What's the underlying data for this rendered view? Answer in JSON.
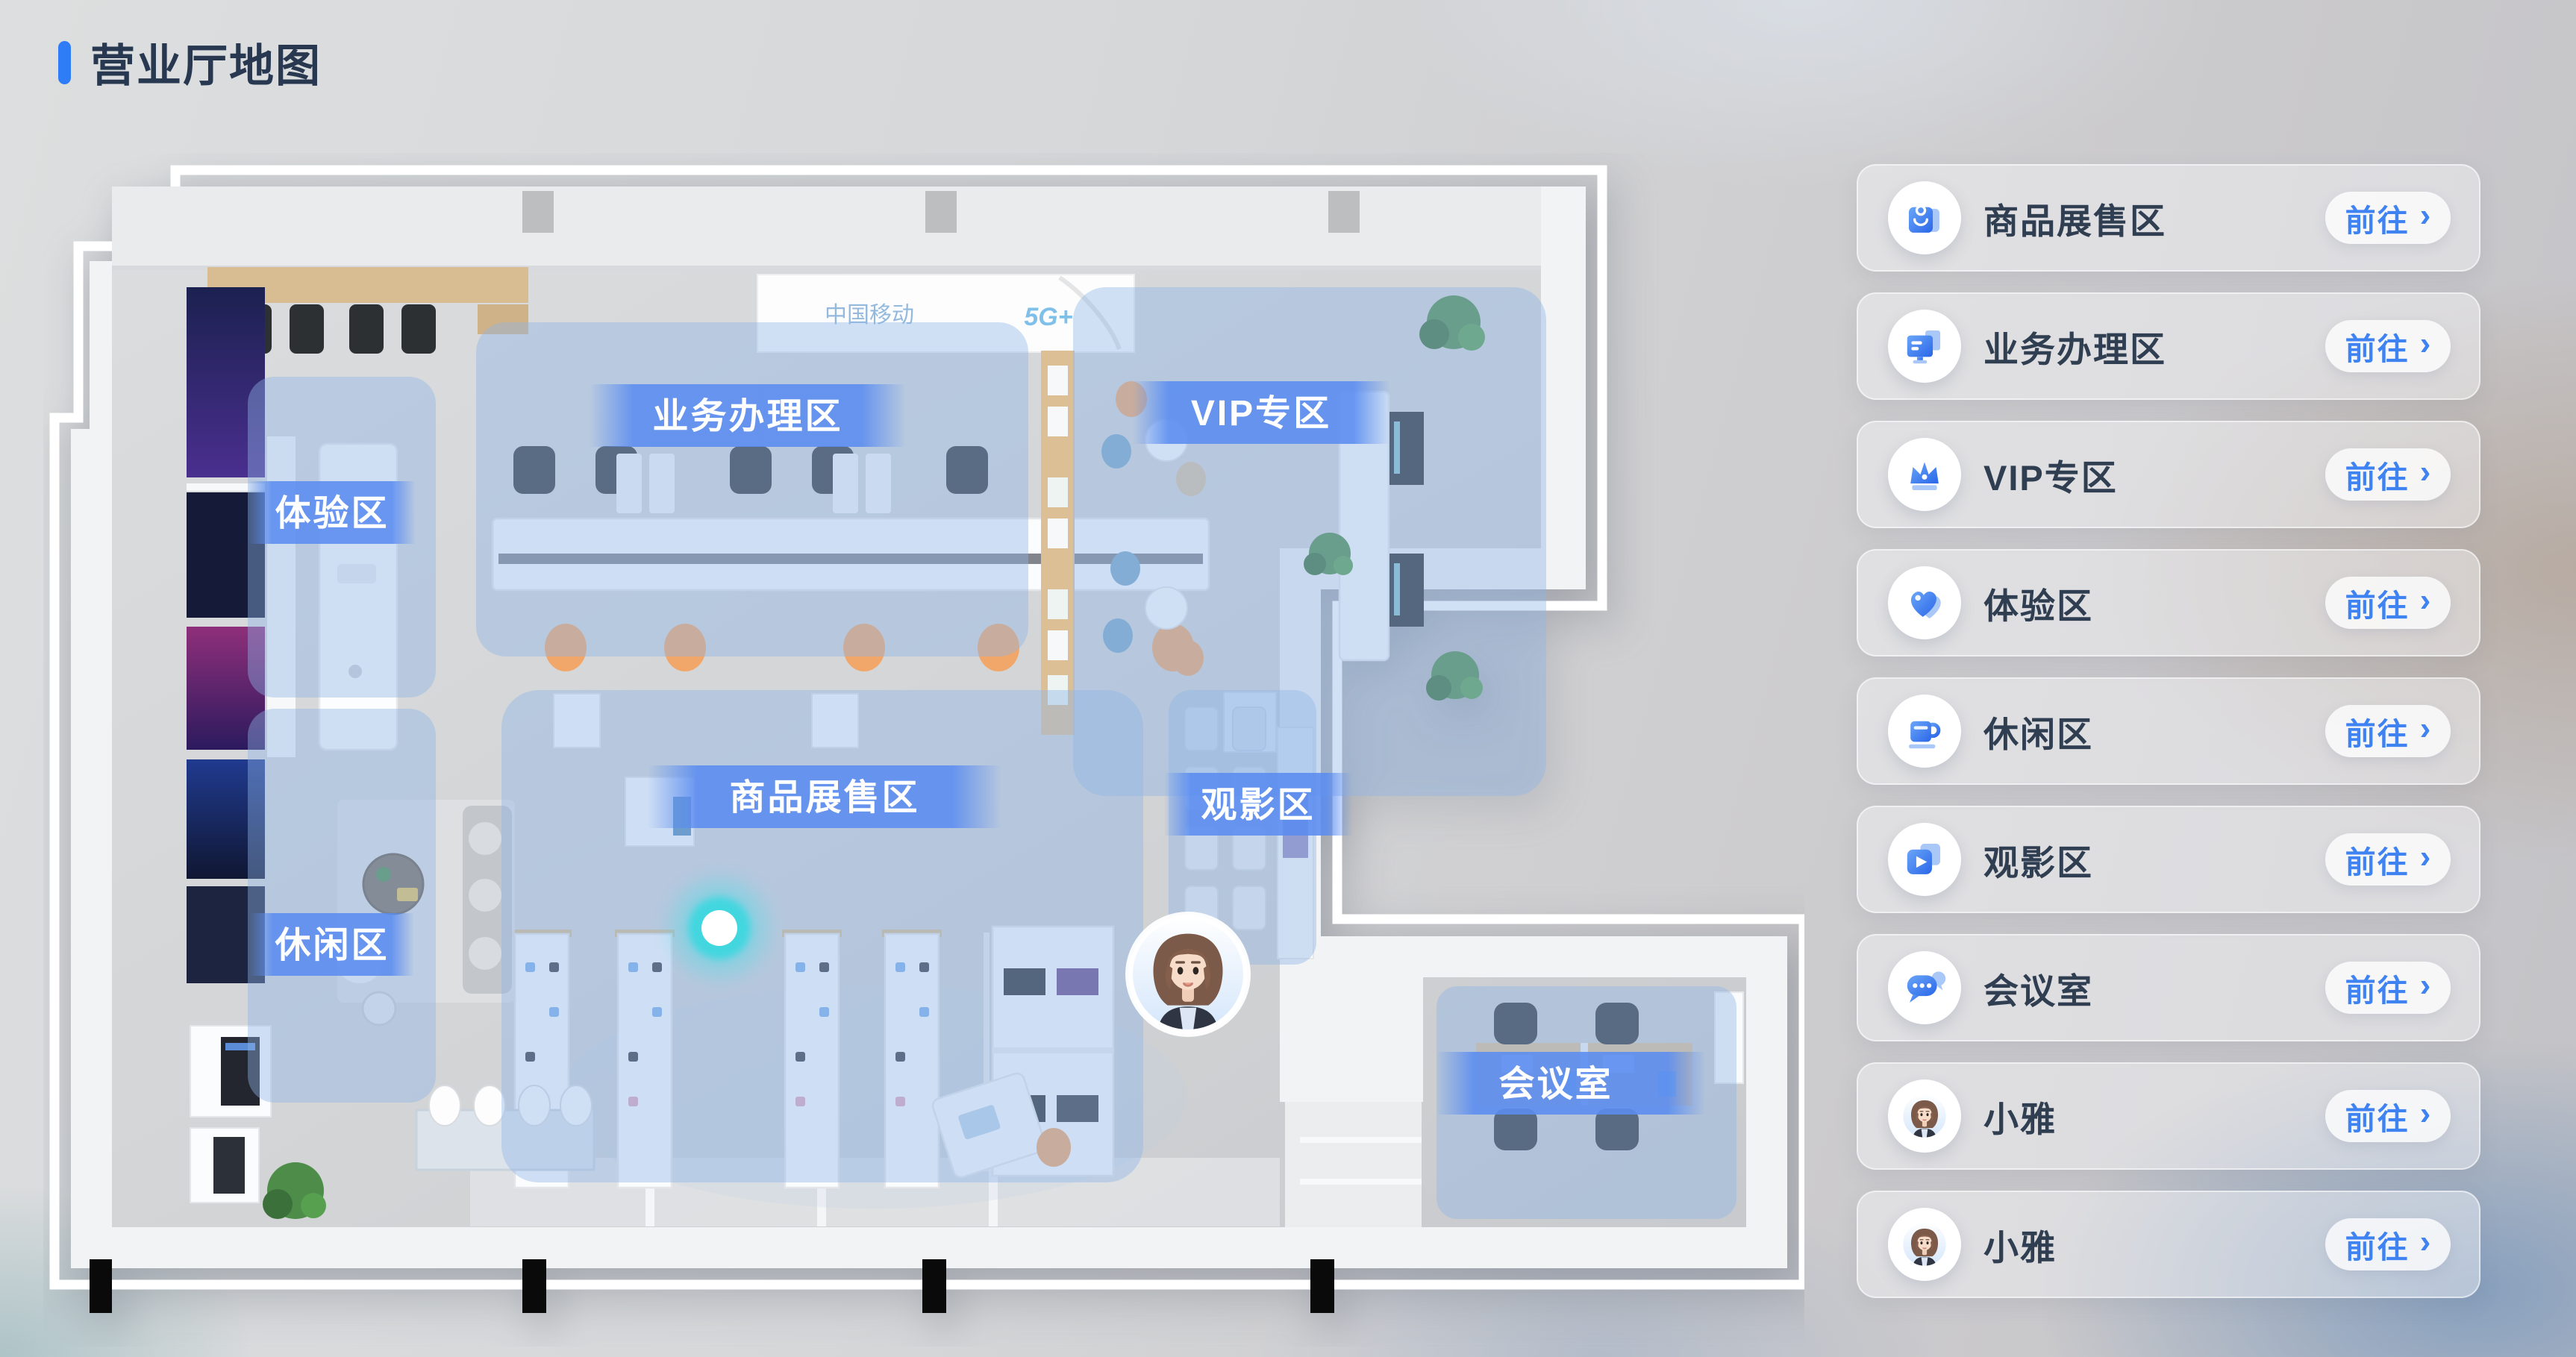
{
  "page": {
    "title": "营业厅地图"
  },
  "map": {
    "zone_labels": [
      "体验区",
      "业务办理区",
      "VIP专区",
      "商品展售区",
      "观影区",
      "休闲区",
      "会议室"
    ],
    "banner": {
      "brand": "中国移动",
      "sub": "5G+"
    },
    "location_dot": "current-position",
    "colors": {
      "accent_blue": "#3f82f2",
      "zone_overlay": "#8fb4e6",
      "label_band": "#5a8cf0",
      "glow_cyan": "#3ee0e6",
      "title_text": "#273850"
    }
  },
  "sidebar": {
    "chevron": "›",
    "items": [
      {
        "label": "商品展售区",
        "action": "前往",
        "icon": "shopping-bag-icon"
      },
      {
        "label": "业务办理区",
        "action": "前往",
        "icon": "monitor-icon"
      },
      {
        "label": "VIP专区",
        "action": "前往",
        "icon": "crown-icon"
      },
      {
        "label": "体验区",
        "action": "前往",
        "icon": "heart-icon"
      },
      {
        "label": "休闲区",
        "action": "前往",
        "icon": "coffee-cup-icon"
      },
      {
        "label": "观影区",
        "action": "前往",
        "icon": "video-play-icon"
      },
      {
        "label": "会议室",
        "action": "前往",
        "icon": "chat-bubbles-icon"
      },
      {
        "label": "小雅",
        "action": "前往",
        "icon": "avatar-xiaoya"
      },
      {
        "label": "小雅",
        "action": "前往",
        "icon": "avatar-xiaoya"
      }
    ]
  }
}
